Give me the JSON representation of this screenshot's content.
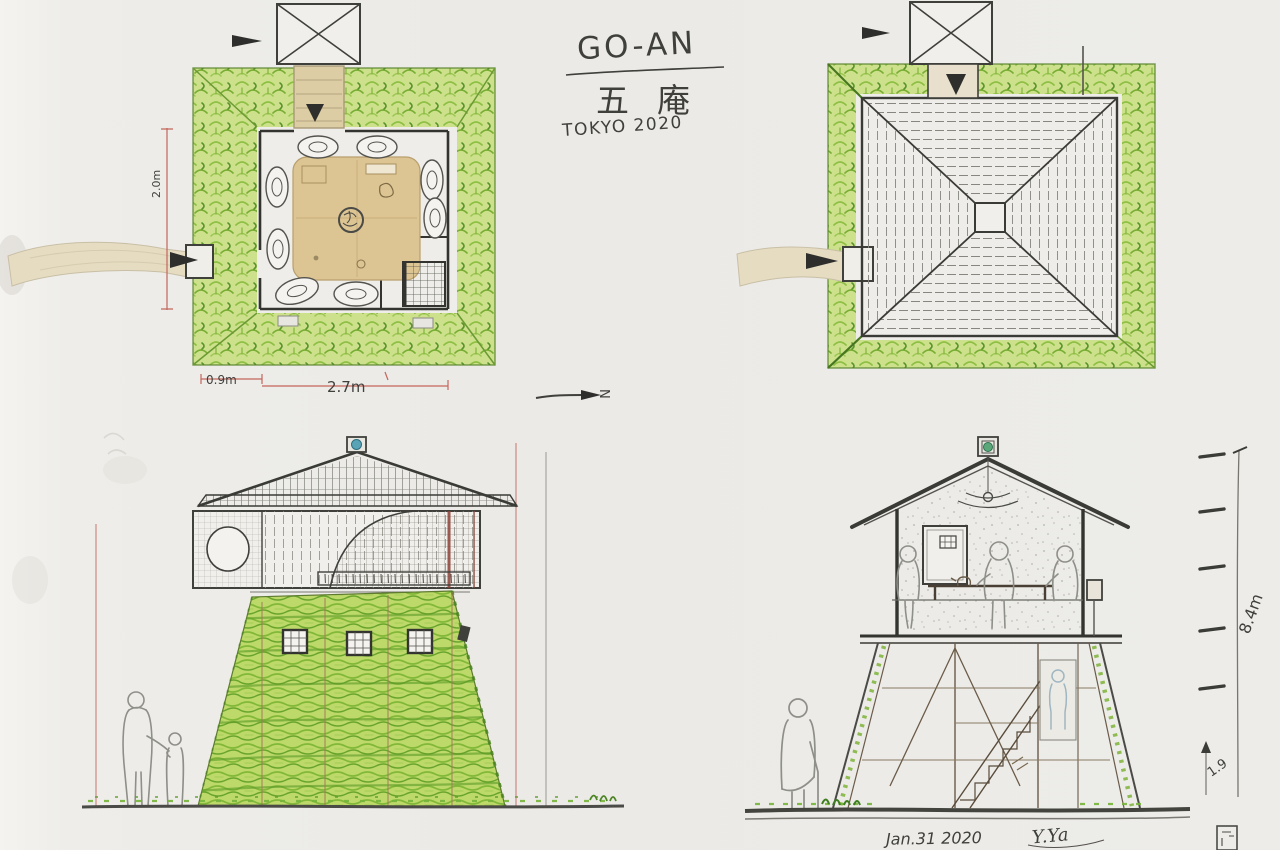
{
  "title_block": {
    "title": "GO-AN",
    "title_jp": "五庵",
    "location_year": "TOKYO 2020"
  },
  "dimensions": {
    "plan_bottom_left": "0.9m",
    "plan_bottom_main": "2.7m",
    "plan_left_vertical": "2.0m",
    "section_total_height": "8.4m",
    "section_lower_height": "1.9",
    "north_label": "N"
  },
  "footer": {
    "date": "Jan.31 2020",
    "signature": "Y.Ya"
  },
  "colors": {
    "paper": "#ebeae6",
    "ink": "#3f3f3c",
    "hedge_green": "#9cc653",
    "moss_green": "#7fb33a",
    "dark_green": "#58922a",
    "tan_path": "#e2d7ba",
    "table_tan": "#dcc493",
    "dimension_red": "#c4524a",
    "finial_teal": "#58a3b5",
    "finial_green": "#5aa87a"
  }
}
